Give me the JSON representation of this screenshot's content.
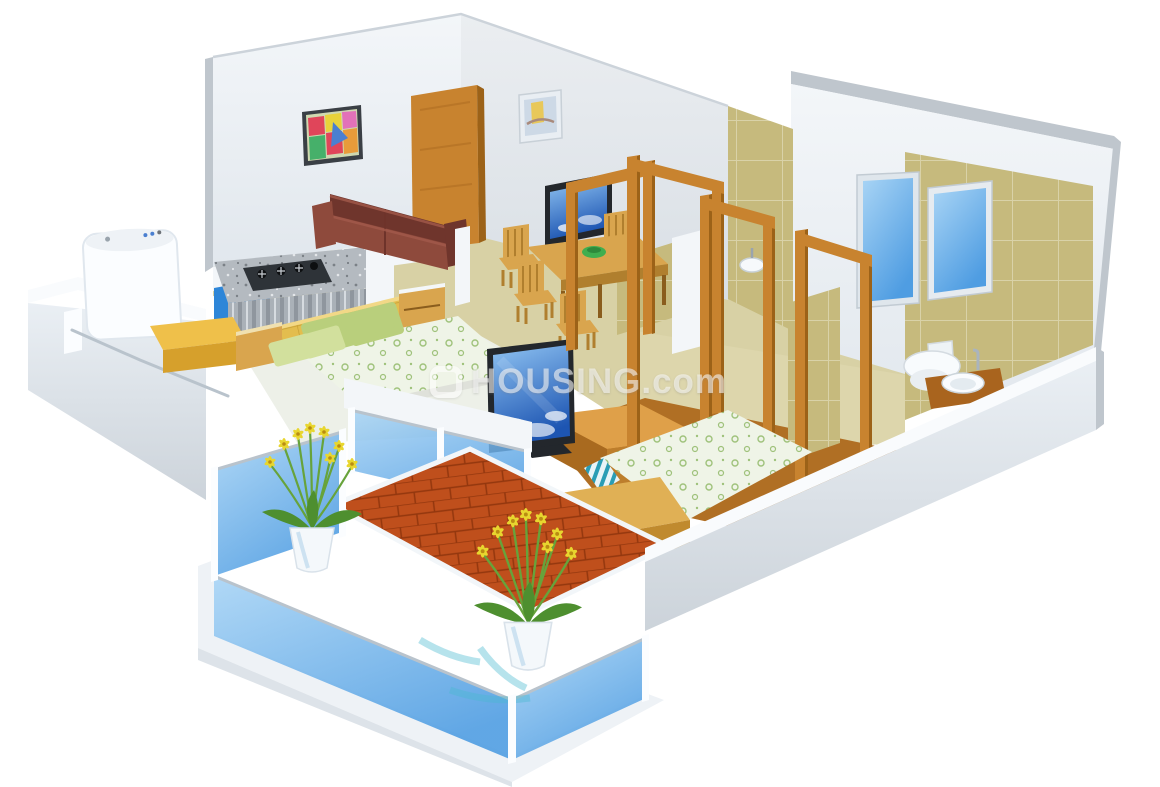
{
  "watermark": {
    "text": "HOUSING.com",
    "logo": "housing-logo"
  },
  "palette": {
    "background": "#ffffff",
    "wall-face": "#f3f6f9",
    "wall-shade": "#e1e7ed",
    "wall-top": "#f9fbfd",
    "wall-edge": "#bfc6cd",
    "wood": "#c8832f",
    "wood-dark": "#9c6218",
    "wood-light": "#dfa049",
    "furn-wood": "#d9a54e",
    "furn-wood-dark": "#b07f2e",
    "floor-beige": "#d8d1a5",
    "floor-pale": "#edf0e8",
    "floor-bath": "#ddd6ac",
    "floor-wood": "#b06f24",
    "tile-tan": "#c6ba7d",
    "tile-grout": "#d9d2a8",
    "glass-blue": "#4f9de2",
    "glass-blue-light": "#a8d4f5",
    "terracotta": "#bf4f1c",
    "terracotta-line": "#93370e",
    "sofa": "#8e4a3c",
    "sofa-dark": "#6f352c",
    "headboard-yellow": "#e3bd4e",
    "pillow-green": "#b9cf7c",
    "pillow-light": "#d2e09d",
    "sheet-floral": "#eff4e7",
    "sheet-motif": "#9fc27b",
    "granite": "#b4bac0",
    "cabinet-blue": "#2e86d8",
    "stove-dark": "#2e3338",
    "tv-frame": "#23272c",
    "screen-sky-top": "#8fc3f2",
    "screen-sky-deep": "#1d55b2",
    "flower-yellow": "#e8d62f",
    "stem-green": "#67a33b",
    "leaf-green": "#4e8f2f",
    "pot-white": "#f4f8fb",
    "appliance-white": "#fbfdff",
    "chrome": "#b9c3cc"
  },
  "scene": {
    "type": "3d-isometric-floor-plan",
    "rooms": [
      {
        "name": "living-room",
        "objects": [
          "leather-sofa",
          "abstract-painting",
          "pastel-painting",
          "entrance-door"
        ]
      },
      {
        "name": "dining-area",
        "objects": [
          "dining-table",
          "wooden-chairs",
          "wall-tv",
          "fruit-bowl"
        ]
      },
      {
        "name": "kitchen",
        "objects": [
          "granite-counter",
          "gas-stove",
          "blue-cabinets"
        ]
      },
      {
        "name": "utility",
        "objects": [
          "washing-machine",
          "drying-rail",
          "yellow-counter"
        ]
      },
      {
        "name": "master-bedroom",
        "objects": [
          "double-bed",
          "yellow-headboard",
          "green-pillows",
          "side-tables"
        ]
      },
      {
        "name": "bedroom-2",
        "objects": [
          "double-bed",
          "wooden-bench",
          "tv-unit",
          "flat-screen-tv"
        ]
      },
      {
        "name": "bathroom-1",
        "objects": [
          "tan-tiled-walls",
          "wash-basin"
        ]
      },
      {
        "name": "bathroom-2",
        "objects": [
          "tan-tiled-walls",
          "toilet",
          "wash-basin",
          "windows"
        ]
      },
      {
        "name": "balcony",
        "objects": [
          "glass-railing",
          "terracotta-floor",
          "flower-pots"
        ]
      },
      {
        "name": "passage",
        "objects": [
          "wooden-door-frames"
        ]
      }
    ]
  }
}
